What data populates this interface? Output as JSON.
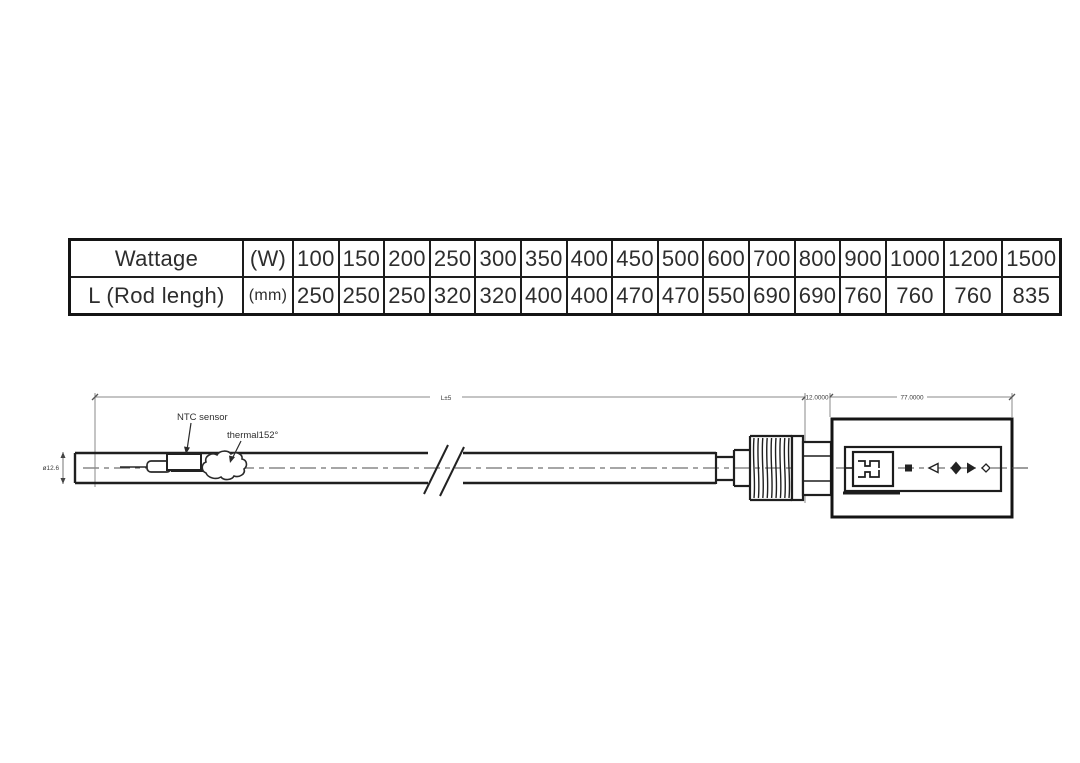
{
  "table": {
    "row1_label": "Wattage",
    "row1_unit": "(W)",
    "row2_label": "L (Rod lengh)",
    "row2_unit": "(mm)",
    "wattage_values": [
      "100",
      "150",
      "200",
      "250",
      "300",
      "350",
      "400",
      "450",
      "500",
      "600",
      "700",
      "800",
      "900",
      "1000",
      "1200",
      "1500"
    ],
    "rod_length_values": [
      "250",
      "250",
      "250",
      "320",
      "320",
      "400",
      "400",
      "470",
      "470",
      "550",
      "690",
      "690",
      "760",
      "760",
      "760",
      "835"
    ]
  },
  "drawing": {
    "dim_total_length": "L±5",
    "dim_hex_length": "12.0000",
    "dim_housing_length": "77.0000",
    "label_ntc": "NTC sensor",
    "label_thermal": "thermal152°",
    "label_diameter": "ø12.6"
  },
  "colors": {
    "outline": "#1f1f1f",
    "dim_line": "#777777",
    "text": "#333333",
    "background": "#ffffff"
  }
}
